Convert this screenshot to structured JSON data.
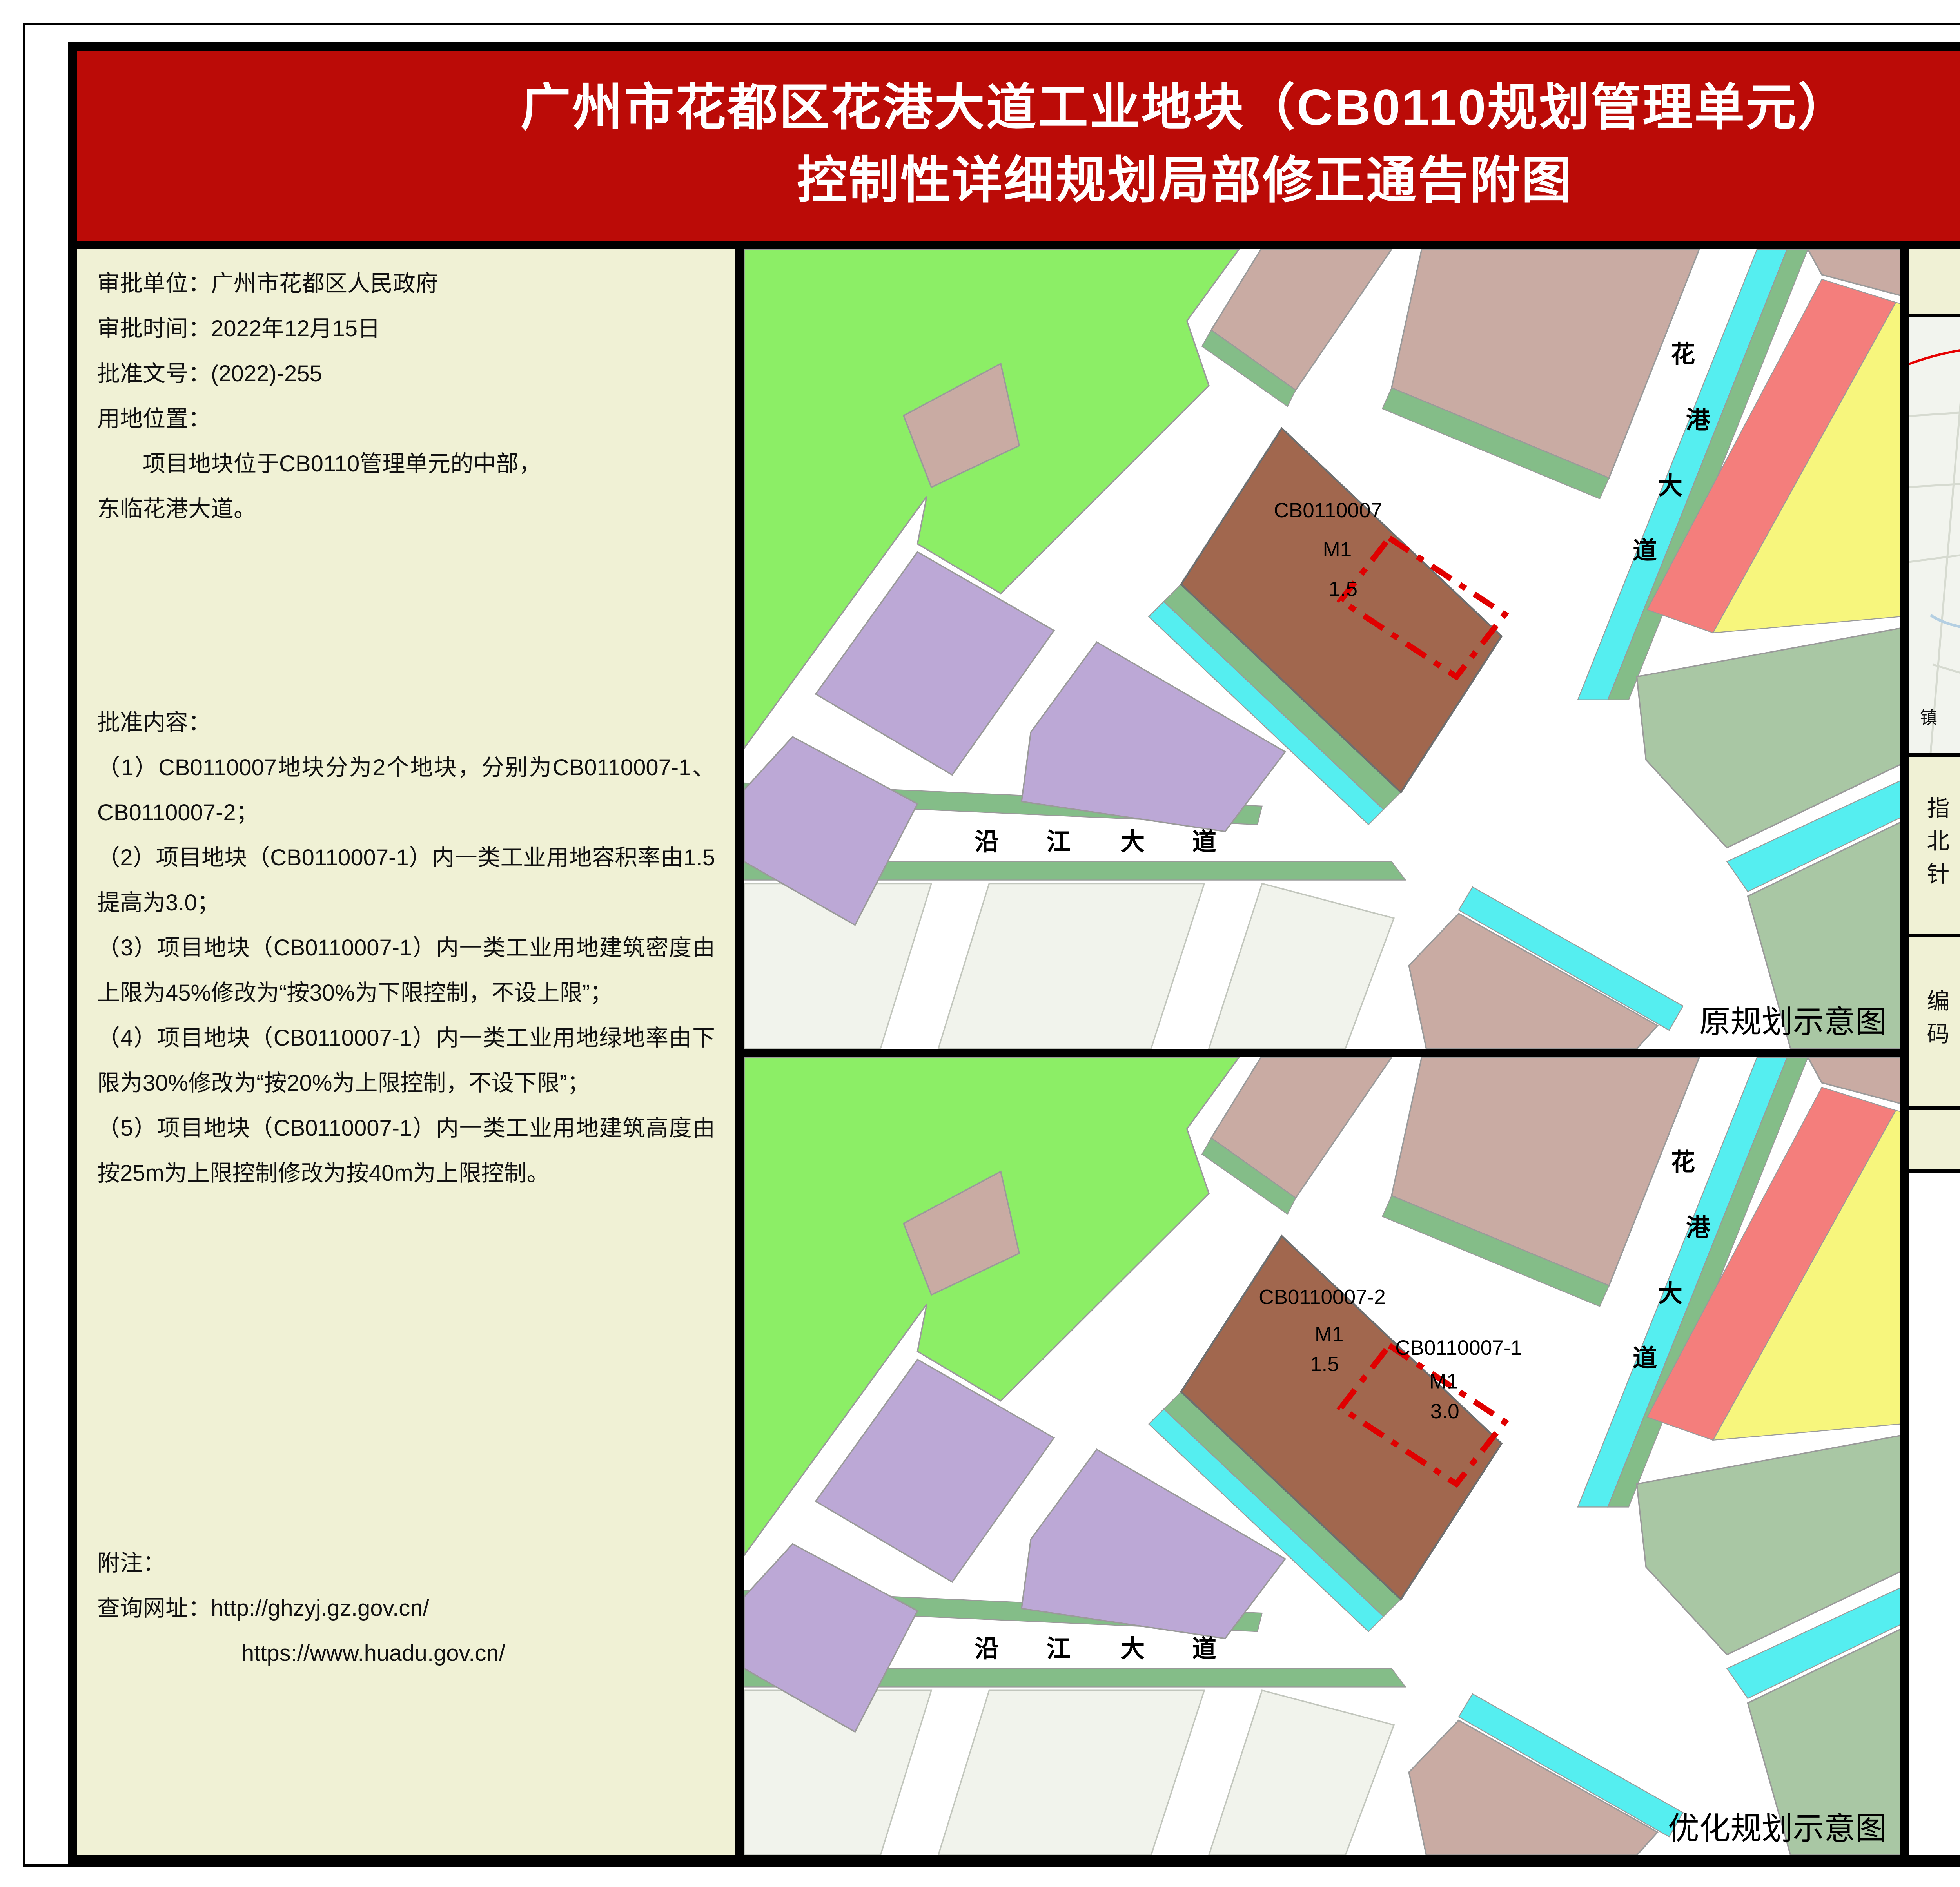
{
  "title": {
    "line1": "广州市花都区花港大道工业地块（CB0110规划管理单元）",
    "line2": "控制性详细规划局部修正通告附图"
  },
  "info_panel": {
    "approval_unit": "审批单位：广州市花都区人民政府",
    "approval_date": "审批时间：2022年12月15日",
    "approval_doc_no": "批准文号：(2022)-255",
    "location_title": "用地位置：",
    "location_line1": "　　项目地块位于CB0110管理单元的中部，",
    "location_line2": "东临花港大道。",
    "approval_content_title": "批准内容：",
    "approval_items": [
      "（1）CB0110007地块分为2个地块，分别为CB0110007-1、CB0110007-2；",
      "（2）项目地块（CB0110007-1）内一类工业用地容积率由1.5提高为3.0；",
      "（3）项目地块（CB0110007-1）内一类工业用地建筑密度由上限为45%修改为“按30%为下限控制，不设上限”；",
      "（4）项目地块（CB0110007-1）内一类工业用地绿地率由下限为30%修改为“按20%为上限控制，不设下限”；",
      "（5）项目地块（CB0110007-1）内一类工业用地建筑高度由按25m为上限控制修改为按40m为上限控制。"
    ],
    "note_title": "附注：",
    "note_url_line1": "查询网址：http://ghzyj.gz.gov.cn/",
    "note_url_line2": "https://www.huadu.gov.cn/"
  },
  "maps": {
    "shared": {
      "huagang_chars": [
        "花",
        "港",
        "大",
        "道"
      ],
      "yanjiang_chars": [
        "沿",
        "江",
        "大",
        "道"
      ]
    },
    "original": {
      "caption": "原规划示意图",
      "plot_code": "CB0110007",
      "plot_use": "M1",
      "plot_far": "1.5"
    },
    "optimized": {
      "caption": "优化规划示意图",
      "plot2_code": "CB0110007-2",
      "plot2_use": "M1",
      "plot2_far": "1.5",
      "plot1_code": "CB0110007-1",
      "plot1_use": "M1",
      "plot1_far": "3.0"
    }
  },
  "sidebar": {
    "location_map_title": "区位图",
    "location_map_labels": {
      "huacheng": "花城街",
      "huadu_gov": "花都区政府",
      "xinhua": "新华街",
      "xiuquan": "秀全街",
      "gqgs_chars": [
        "广",
        "清",
        "高",
        "速"
      ],
      "project": "项目位置",
      "zhen": "镇"
    },
    "compass": {
      "label": "指北针",
      "north": "N"
    },
    "code": {
      "label": "编码",
      "value": "CB0110"
    },
    "legend": {
      "title": "图　例",
      "items": [
        {
          "label": "项目地块范围",
          "swatch": "red-dashed-box"
        },
        {
          "label": "一类工业用地",
          "swatch": "brown-fill"
        }
      ]
    }
  },
  "colors": {
    "banner_red": "#BB0B07",
    "cream": "#F0F1D5",
    "industrial_brown": "#A1674E",
    "greenery": "#8CEE66",
    "residential_mauve": "#C9ABA3",
    "purple_block": "#BCA8D6",
    "sage_block": "#A9C7A4",
    "water_cyan": "#55EEF0",
    "green_strip": "#84BD88",
    "project_boundary_red": "#E00000"
  }
}
